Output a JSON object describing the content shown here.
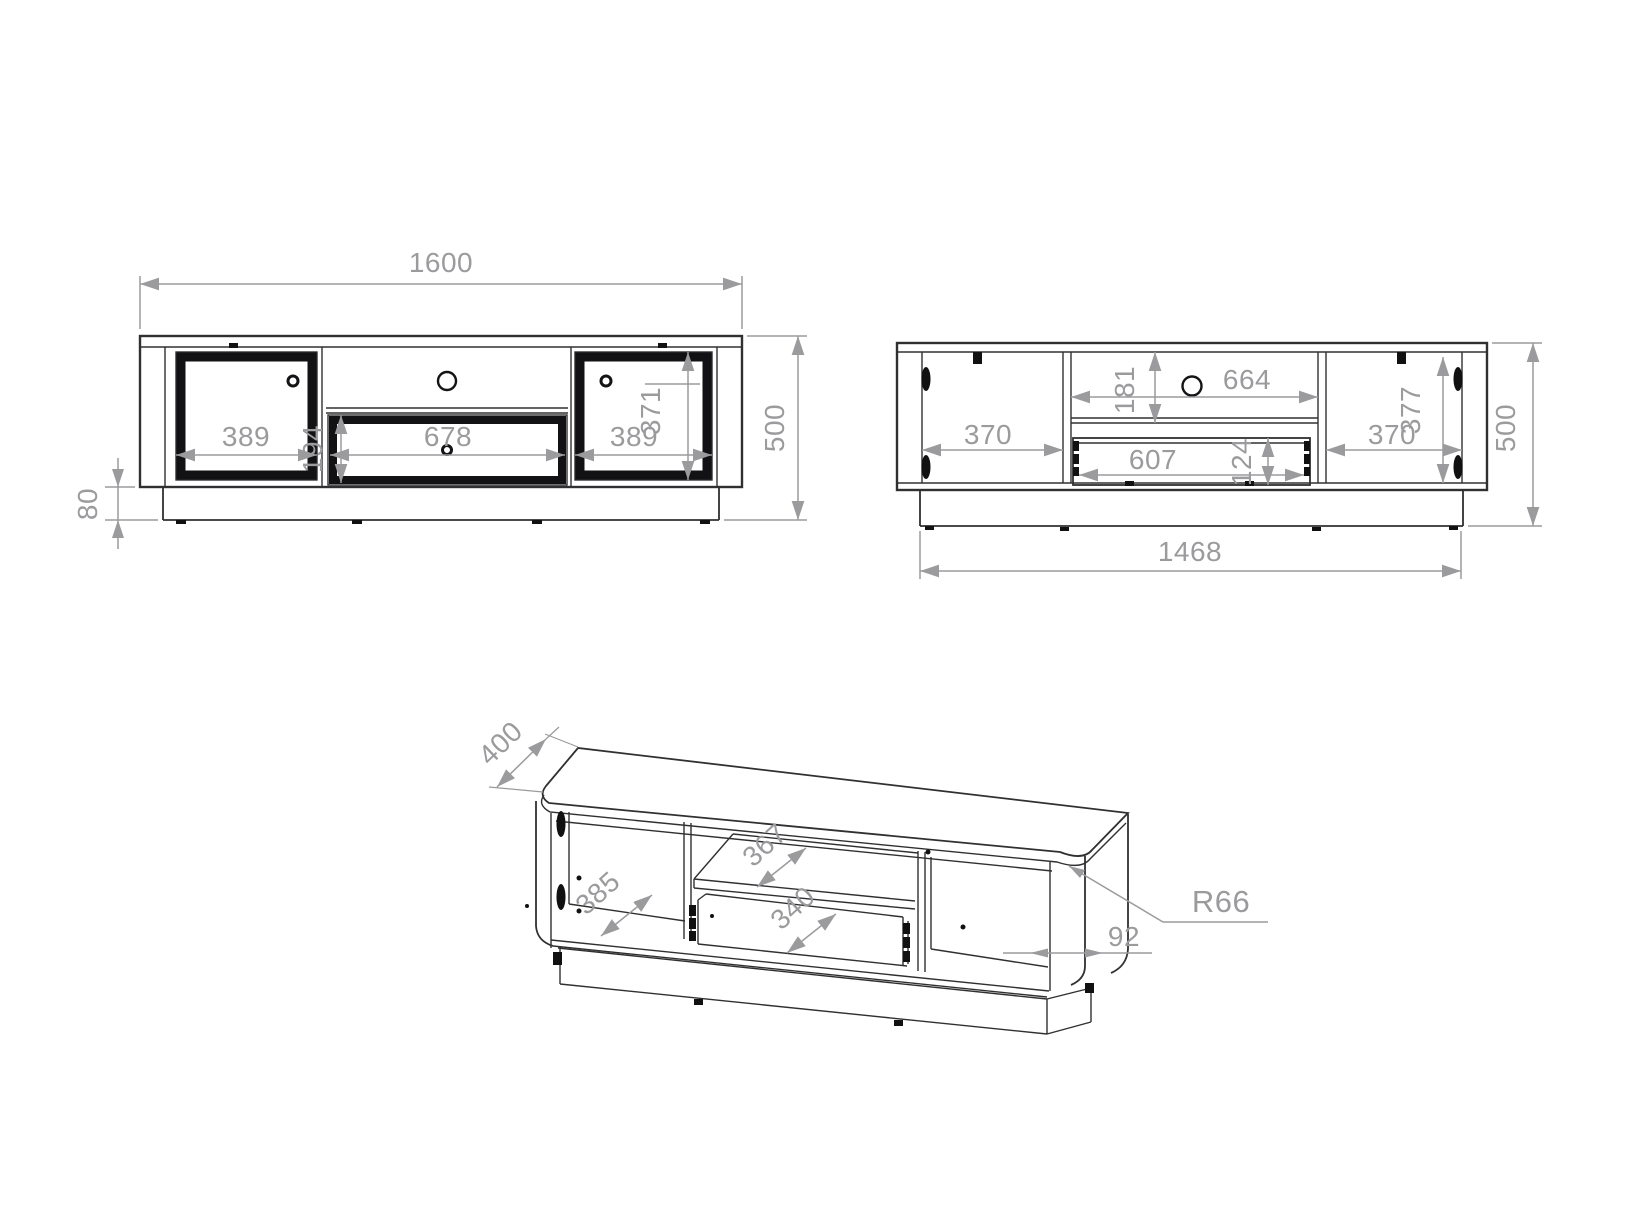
{
  "drawing": {
    "type": "furniture technical drawing - TV cabinet, three views",
    "colors": {
      "line": "#303032",
      "black_parts": "#111111",
      "dimension": "#9b9b9e",
      "background": "#ffffff"
    },
    "views": {
      "front": {
        "label": "front-view",
        "width": "1600",
        "height": "500",
        "plinth_height": "80",
        "left_door_width": "389",
        "drawer_width": "678",
        "drawer_height": "194",
        "right_door_width": "389",
        "door_height": "371"
      },
      "back": {
        "label": "back-view",
        "bottom_width": "1468",
        "height": "500",
        "left_compartment_width": "370",
        "niche_height": "181",
        "niche_width": "664",
        "drawer_width": "607",
        "drawer_height": "124",
        "right_compartment_width": "370",
        "inner_height": "377"
      },
      "isometric": {
        "label": "isometric-view",
        "depth": "400",
        "left_compartment_depth": "385",
        "shelf_depth": "367",
        "drawer_depth": "340",
        "side_panel_width": "92",
        "corner_radius": "R66"
      }
    }
  }
}
